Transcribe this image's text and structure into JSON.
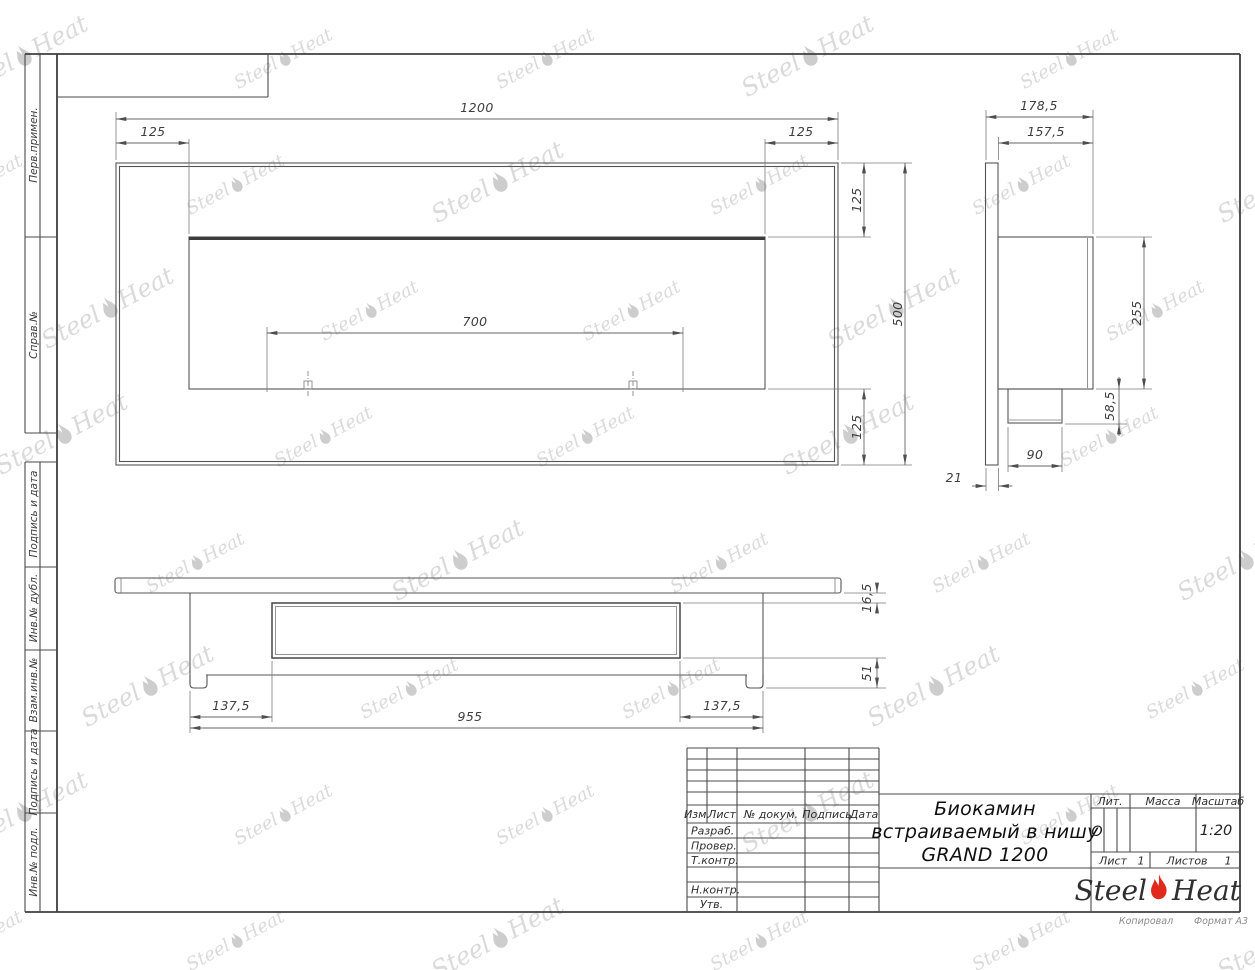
{
  "sheet": {
    "copied_note": "Копировал",
    "format_note": "Формат А3"
  },
  "frame_labels": {
    "perv": "Перв.примен.",
    "sprav": "Справ.№",
    "podp1": "Подпись и дата",
    "inv_dubl": "Инв.№ дубл.",
    "vzam": "Взам.инв.№",
    "podp2": "Подпись и дата",
    "inv_podl": "Инв.№ подл."
  },
  "title_block": {
    "cols": {
      "izm": "Изм.",
      "list": "Лист",
      "ndok": "№ докум.",
      "podp": "Подпись",
      "data": "Дата"
    },
    "rows": {
      "razrab": "Разраб.",
      "prover": "Провер.",
      "tkontr": "Т.контр.",
      "nkontr": "Н.контр.",
      "utv": "Утв."
    },
    "title_line1": "Биокамин",
    "title_line2": "встраиваемый в нишу",
    "title_line3": "GRAND 1200",
    "lit_label": "Лит.",
    "lit_value": "О",
    "massa_label": "Масса",
    "scale_label": "Масштаб",
    "scale_value": "1:20",
    "sheet_label": "Лист",
    "sheet_value": "1",
    "sheets_label": "Листов",
    "sheets_value": "1",
    "brand_left": "Steel",
    "brand_right": "Heat"
  },
  "dimensions": {
    "front_width": "1200",
    "front_inset_left": "125",
    "front_inset_right": "125",
    "front_inset_top": "125",
    "front_height": "500",
    "front_inset_bottom": "125",
    "front_slot": "700",
    "side_depth_total": "178,5",
    "side_depth_body": "157,5",
    "side_body_height": "255",
    "side_box_height": "58,5",
    "side_box_width": "90",
    "side_flange": "21",
    "top_step": "16,5",
    "top_lower": "51",
    "top_inset_left": "137,5",
    "top_body_width": "955",
    "top_inset_right": "137,5"
  },
  "watermark": {
    "left": "Steel",
    "right": "Heat"
  }
}
